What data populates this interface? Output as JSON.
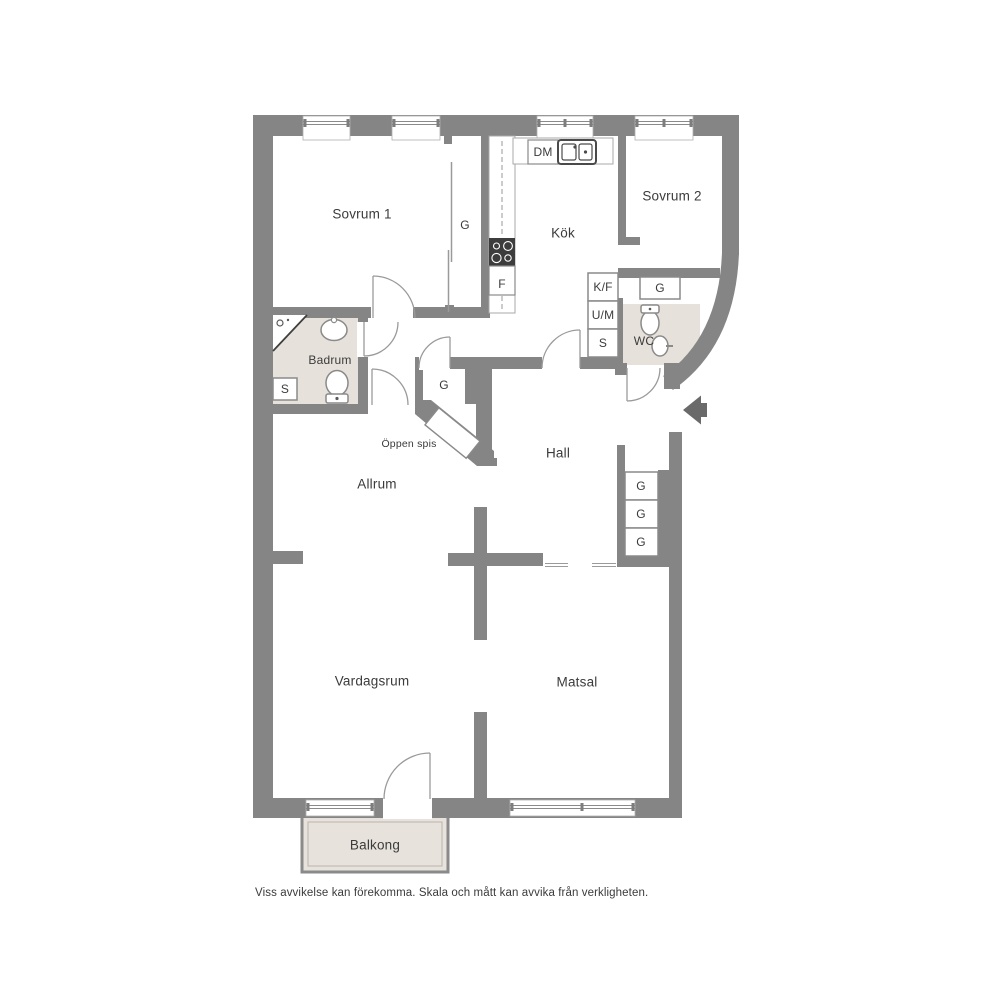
{
  "labels": {
    "sovrum1": "Sovrum 1",
    "sovrum1_wardrobe_g": "G",
    "kok": "Kök",
    "dm": "DM",
    "sovrum2": "Sovrum 2",
    "f": "F",
    "kf": "K/F",
    "um": "U/M",
    "s_by_wc": "S",
    "g_by_wc": "G",
    "wc": "WC",
    "badrum": "Badrum",
    "s_badrum": "S",
    "g_nook": "G",
    "oppen_spis": "Öppen spis",
    "hall": "Hall",
    "allrum": "Allrum",
    "g_hall_1": "G",
    "g_hall_2": "G",
    "g_hall_3": "G",
    "vardagsrum": "Vardagsrum",
    "matsal": "Matsal",
    "balkong": "Balkong",
    "disclaimer": "Viss avvikelse kan förekomma. Skala och mått kan avvika från verkligheten."
  },
  "colors": {
    "wall": "#858585",
    "wet_room_floor": "#e6e1da",
    "balcony_floor": "#e7e2db",
    "fixture_outline": "#8a8a8a",
    "thin_outline": "#a9a9a9",
    "stove": "#3d3d3d",
    "entrance_arrow": "#6a6a6a",
    "text": "#3b3b3b"
  }
}
